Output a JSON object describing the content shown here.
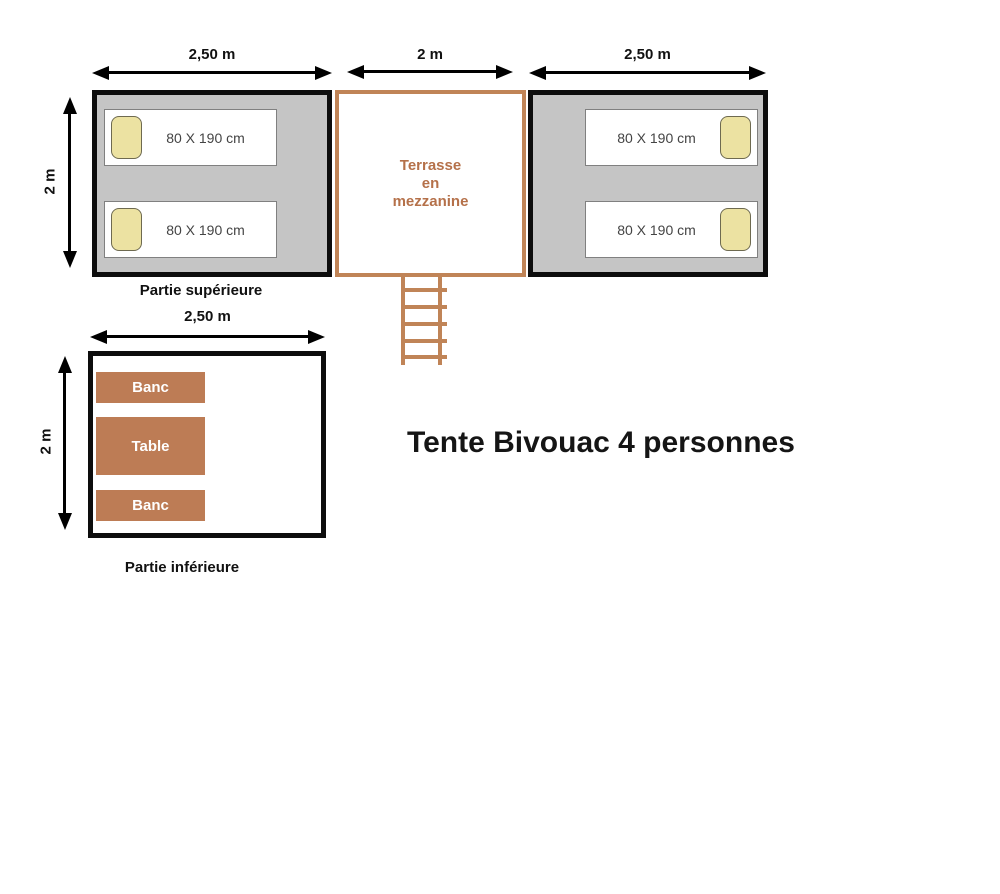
{
  "title": "Tente Bivouac 4 personnes",
  "upper": {
    "section_label": "Partie supérieure",
    "left_room": {
      "width_label": "2,50 m",
      "height_label": "2 m",
      "beds": [
        {
          "label": "80 X 190 cm"
        },
        {
          "label": "80 X 190 cm"
        }
      ]
    },
    "terrace": {
      "width_label": "2 m",
      "lines": [
        "Terrasse",
        "en",
        "mezzanine"
      ]
    },
    "right_room": {
      "width_label": "2,50 m",
      "beds": [
        {
          "label": "80 X 190 cm"
        },
        {
          "label": "80 X 190 cm"
        }
      ]
    }
  },
  "lower": {
    "section_label": "Partie inférieure",
    "width_label": "2,50 m",
    "height_label": "2 m",
    "furniture": [
      {
        "label": "Banc"
      },
      {
        "label": "Table"
      },
      {
        "label": "Banc"
      }
    ]
  },
  "colors": {
    "room_fill": "#c5c5c5",
    "room_border": "#0d0d0d",
    "terracotta_fill": "#bd7c55",
    "terrace_border": "#c08457",
    "terrace_text": "#b5714a",
    "pillow_fill": "#ece2a2",
    "pillow_border": "#6e6a50",
    "bed_border": "#808080",
    "bed_text": "#444444"
  }
}
